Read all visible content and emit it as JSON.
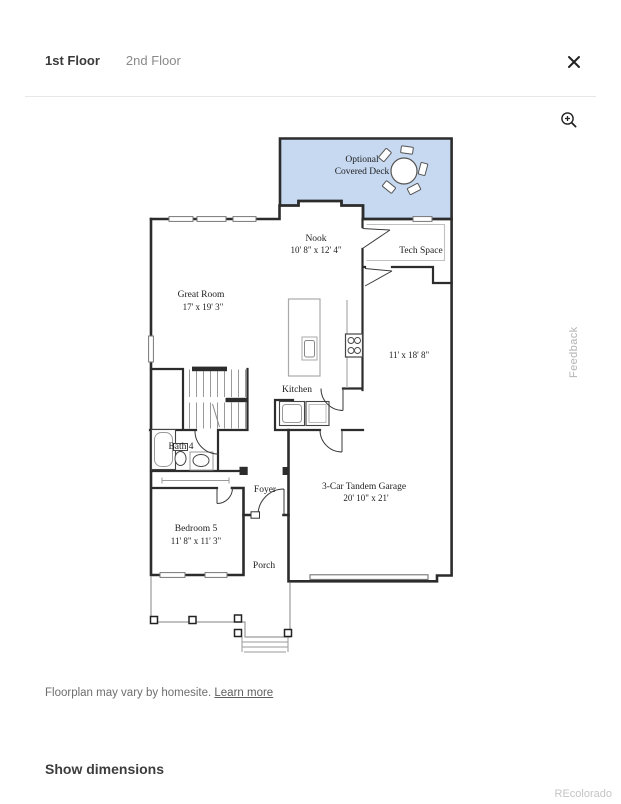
{
  "header": {
    "tabs": [
      {
        "label": "1st Floor",
        "active": true
      },
      {
        "label": "2nd Floor",
        "active": false
      }
    ]
  },
  "floorplan": {
    "deck": {
      "line1": "Optional",
      "line2": "Covered Deck",
      "fill": "#c6d9f1"
    },
    "nook": {
      "name": "Nook",
      "dims": "10' 8\" x 12' 4\""
    },
    "tech_space": {
      "name": "Tech Space"
    },
    "great_room": {
      "name": "Great Room",
      "dims": "17' x 19' 3\""
    },
    "kitchen": {
      "name": "Kitchen"
    },
    "tandem_bay": {
      "dims": "11' x 18' 8\""
    },
    "bath4": {
      "name": "Bath 4"
    },
    "foyer": {
      "name": "Foyer"
    },
    "bedroom5": {
      "name": "Bedroom 5",
      "dims": "11' 8\" x 11' 3\""
    },
    "porch": {
      "name": "Porch"
    },
    "garage": {
      "name": "3-Car Tandem Garage",
      "dims": "20' 10\" x 21'"
    },
    "wall_color": "#2c2c2c"
  },
  "feedback": {
    "label": "Feedback"
  },
  "footer": {
    "disclaimer": "Floorplan may vary by homesite.",
    "learn_more": "Learn more",
    "show_dimensions": "Show dimensions",
    "watermark": "REcolorado"
  }
}
